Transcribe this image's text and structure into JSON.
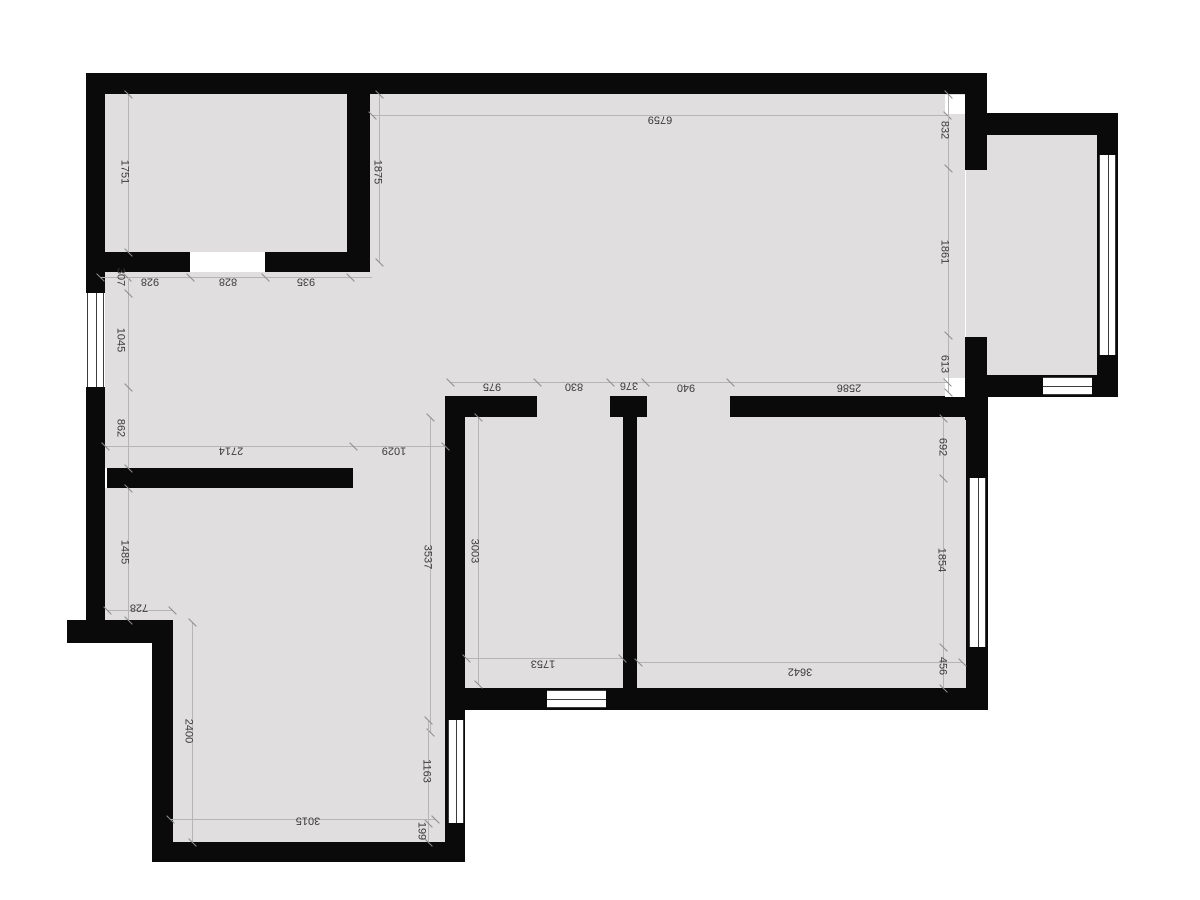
{
  "meta": {
    "type": "architectural-floor-plan",
    "units": "mm",
    "orientation": "labels rotated 180 degrees"
  },
  "colors": {
    "background": "#ffffff",
    "wall": "#0a0a0a",
    "floor": "#e0dede",
    "window": "#ffffff",
    "dim_line": "#b5b5b5",
    "dim_text": "#3b3b3b"
  },
  "floors": [
    [
      105,
      94,
      242,
      158
    ],
    [
      370,
      94,
      595,
      302
    ],
    [
      105,
      270,
      340,
      198
    ],
    [
      353,
      468,
      92,
      20
    ],
    [
      105,
      488,
      340,
      132
    ],
    [
      173,
      620,
      272,
      222
    ],
    [
      465,
      417,
      158,
      271
    ],
    [
      637,
      417,
      330,
      271
    ],
    [
      987,
      135,
      110,
      240
    ],
    [
      966,
      170,
      22,
      167
    ]
  ],
  "walls": [
    [
      86,
      73,
      901,
      21
    ],
    [
      86,
      94,
      19,
      199
    ],
    [
      86,
      387,
      19,
      256
    ],
    [
      67,
      620,
      106,
      23
    ],
    [
      152,
      643,
      21,
      219
    ],
    [
      152,
      842,
      313,
      20
    ],
    [
      445,
      396,
      20,
      466
    ],
    [
      445,
      688,
      543,
      22
    ],
    [
      966,
      397,
      22,
      313
    ],
    [
      965,
      73,
      22,
      97
    ],
    [
      965,
      337,
      22,
      83
    ],
    [
      445,
      396,
      522,
      21
    ],
    [
      987,
      113,
      131,
      22
    ],
    [
      965,
      375,
      153,
      22
    ],
    [
      1097,
      113,
      21,
      284
    ],
    [
      347,
      94,
      23,
      178
    ],
    [
      105,
      252,
      265,
      20
    ],
    [
      107,
      468,
      246,
      20
    ],
    [
      623,
      417,
      14,
      293
    ]
  ],
  "door_gaps_gray": [
    [
      537,
      396,
      73,
      21
    ],
    [
      647,
      396,
      83,
      21
    ]
  ],
  "door_gaps_white": [
    [
      190,
      252,
      75,
      20
    ]
  ],
  "corner_squares": [
    [
      945,
      95,
      20,
      19
    ],
    [
      945,
      378,
      20,
      19
    ]
  ],
  "windows": [
    {
      "r": [
        87,
        293,
        17,
        94
      ],
      "o": "v"
    },
    {
      "r": [
        448,
        720,
        16,
        103
      ],
      "o": "v"
    },
    {
      "r": [
        969,
        478,
        17,
        169
      ],
      "o": "v"
    },
    {
      "r": [
        1099,
        155,
        17,
        200
      ],
      "o": "v"
    },
    {
      "r": [
        1043,
        377,
        49,
        18
      ],
      "o": "h"
    },
    {
      "r": [
        547,
        690,
        59,
        18
      ],
      "o": "h"
    }
  ],
  "dim_lines": [
    {
      "x1": 372,
      "y1": 115,
      "x2": 947,
      "y2": 115,
      "ticks": [
        [
          372,
          115
        ],
        [
          947,
          115
        ]
      ]
    },
    {
      "x1": 948,
      "y1": 94,
      "x2": 948,
      "y2": 392,
      "ticks": [
        [
          948,
          94
        ],
        [
          948,
          168
        ],
        [
          948,
          335
        ],
        [
          948,
          392
        ]
      ]
    },
    {
      "x1": 128,
      "y1": 94,
      "x2": 128,
      "y2": 252,
      "ticks": [
        [
          128,
          94
        ],
        [
          128,
          252
        ]
      ]
    },
    {
      "x1": 379,
      "y1": 94,
      "x2": 379,
      "y2": 262,
      "ticks": [
        [
          379,
          94
        ],
        [
          379,
          262
        ]
      ]
    },
    {
      "x1": 100,
      "y1": 277,
      "x2": 372,
      "y2": 277,
      "ticks": [
        [
          100,
          277
        ],
        [
          127,
          277
        ],
        [
          190,
          277
        ],
        [
          265,
          277
        ],
        [
          350,
          277
        ]
      ]
    },
    {
      "x1": 128,
      "y1": 277,
      "x2": 128,
      "y2": 468,
      "ticks": [
        [
          128,
          293
        ],
        [
          128,
          387
        ],
        [
          128,
          468
        ]
      ]
    },
    {
      "x1": 450,
      "y1": 382,
      "x2": 947,
      "y2": 382,
      "ticks": [
        [
          450,
          382
        ],
        [
          537,
          382
        ],
        [
          610,
          382
        ],
        [
          645,
          382
        ],
        [
          730,
          382
        ],
        [
          947,
          382
        ]
      ]
    },
    {
      "x1": 105,
      "y1": 446,
      "x2": 445,
      "y2": 446,
      "ticks": [
        [
          105,
          446
        ],
        [
          353,
          446
        ],
        [
          445,
          446
        ]
      ]
    },
    {
      "x1": 128,
      "y1": 488,
      "x2": 128,
      "y2": 620,
      "ticks": [
        [
          128,
          488
        ],
        [
          128,
          620
        ]
      ]
    },
    {
      "x1": 192,
      "y1": 622,
      "x2": 192,
      "y2": 842,
      "ticks": [
        [
          192,
          622
        ],
        [
          192,
          842
        ]
      ]
    },
    {
      "x1": 430,
      "y1": 417,
      "x2": 430,
      "y2": 732,
      "ticks": [
        [
          430,
          417
        ],
        [
          430,
          732
        ]
      ]
    },
    {
      "x1": 478,
      "y1": 417,
      "x2": 478,
      "y2": 684,
      "ticks": [
        [
          478,
          417
        ],
        [
          478,
          684
        ]
      ]
    },
    {
      "x1": 107,
      "y1": 610,
      "x2": 172,
      "y2": 610,
      "ticks": [
        [
          107,
          610
        ],
        [
          172,
          610
        ]
      ]
    },
    {
      "x1": 466,
      "y1": 658,
      "x2": 622,
      "y2": 658,
      "ticks": [
        [
          466,
          658
        ],
        [
          622,
          658
        ]
      ]
    },
    {
      "x1": 638,
      "y1": 662,
      "x2": 962,
      "y2": 662,
      "ticks": [
        [
          638,
          662
        ],
        [
          962,
          662
        ]
      ]
    },
    {
      "x1": 943,
      "y1": 418,
      "x2": 943,
      "y2": 688,
      "ticks": [
        [
          943,
          418
        ],
        [
          943,
          478
        ],
        [
          943,
          647
        ],
        [
          943,
          688
        ]
      ]
    },
    {
      "x1": 428,
      "y1": 720,
      "x2": 428,
      "y2": 842,
      "ticks": [
        [
          428,
          720
        ],
        [
          428,
          823
        ],
        [
          428,
          842
        ]
      ]
    },
    {
      "x1": 170,
      "y1": 819,
      "x2": 435,
      "y2": 819,
      "ticks": [
        [
          170,
          819
        ],
        [
          435,
          819
        ]
      ]
    }
  ],
  "dimensions": [
    {
      "value": "6759",
      "x": 660,
      "y": 119,
      "o": "h"
    },
    {
      "value": "1751",
      "x": 124,
      "y": 172,
      "o": "v"
    },
    {
      "value": "1875",
      "x": 377,
      "y": 172,
      "o": "v"
    },
    {
      "value": "832",
      "x": 944,
      "y": 130,
      "o": "v"
    },
    {
      "value": "307",
      "x": 120,
      "y": 277,
      "o": "v"
    },
    {
      "value": "928",
      "x": 150,
      "y": 281,
      "o": "h"
    },
    {
      "value": "828",
      "x": 228,
      "y": 281,
      "o": "h"
    },
    {
      "value": "935",
      "x": 306,
      "y": 281,
      "o": "h"
    },
    {
      "value": "1045",
      "x": 120,
      "y": 340,
      "o": "v"
    },
    {
      "value": "1861",
      "x": 944,
      "y": 252,
      "o": "v"
    },
    {
      "value": "862",
      "x": 120,
      "y": 428,
      "o": "v"
    },
    {
      "value": "613",
      "x": 944,
      "y": 364,
      "o": "v"
    },
    {
      "value": "975",
      "x": 492,
      "y": 386,
      "o": "h"
    },
    {
      "value": "830",
      "x": 574,
      "y": 386,
      "o": "h"
    },
    {
      "value": "376",
      "x": 629,
      "y": 385,
      "o": "h"
    },
    {
      "value": "940",
      "x": 686,
      "y": 387,
      "o": "h"
    },
    {
      "value": "2586",
      "x": 849,
      "y": 387,
      "o": "h"
    },
    {
      "value": "2714",
      "x": 231,
      "y": 450,
      "o": "h"
    },
    {
      "value": "1029",
      "x": 394,
      "y": 450,
      "o": "h"
    },
    {
      "value": "692",
      "x": 942,
      "y": 447,
      "o": "v"
    },
    {
      "value": "1485",
      "x": 124,
      "y": 552,
      "o": "v"
    },
    {
      "value": "3537",
      "x": 427,
      "y": 557,
      "o": "v"
    },
    {
      "value": "3003",
      "x": 474,
      "y": 551,
      "o": "v"
    },
    {
      "value": "1854",
      "x": 941,
      "y": 560,
      "o": "v"
    },
    {
      "value": "728",
      "x": 139,
      "y": 607,
      "o": "h"
    },
    {
      "value": "456",
      "x": 942,
      "y": 666,
      "o": "v"
    },
    {
      "value": "1753",
      "x": 543,
      "y": 663,
      "o": "h"
    },
    {
      "value": "3642",
      "x": 800,
      "y": 671,
      "o": "h"
    },
    {
      "value": "2400",
      "x": 188,
      "y": 731,
      "o": "v"
    },
    {
      "value": "1163",
      "x": 426,
      "y": 771,
      "o": "v"
    },
    {
      "value": "3015",
      "x": 308,
      "y": 820,
      "o": "h"
    },
    {
      "value": "199",
      "x": 421,
      "y": 831,
      "o": "v"
    }
  ]
}
